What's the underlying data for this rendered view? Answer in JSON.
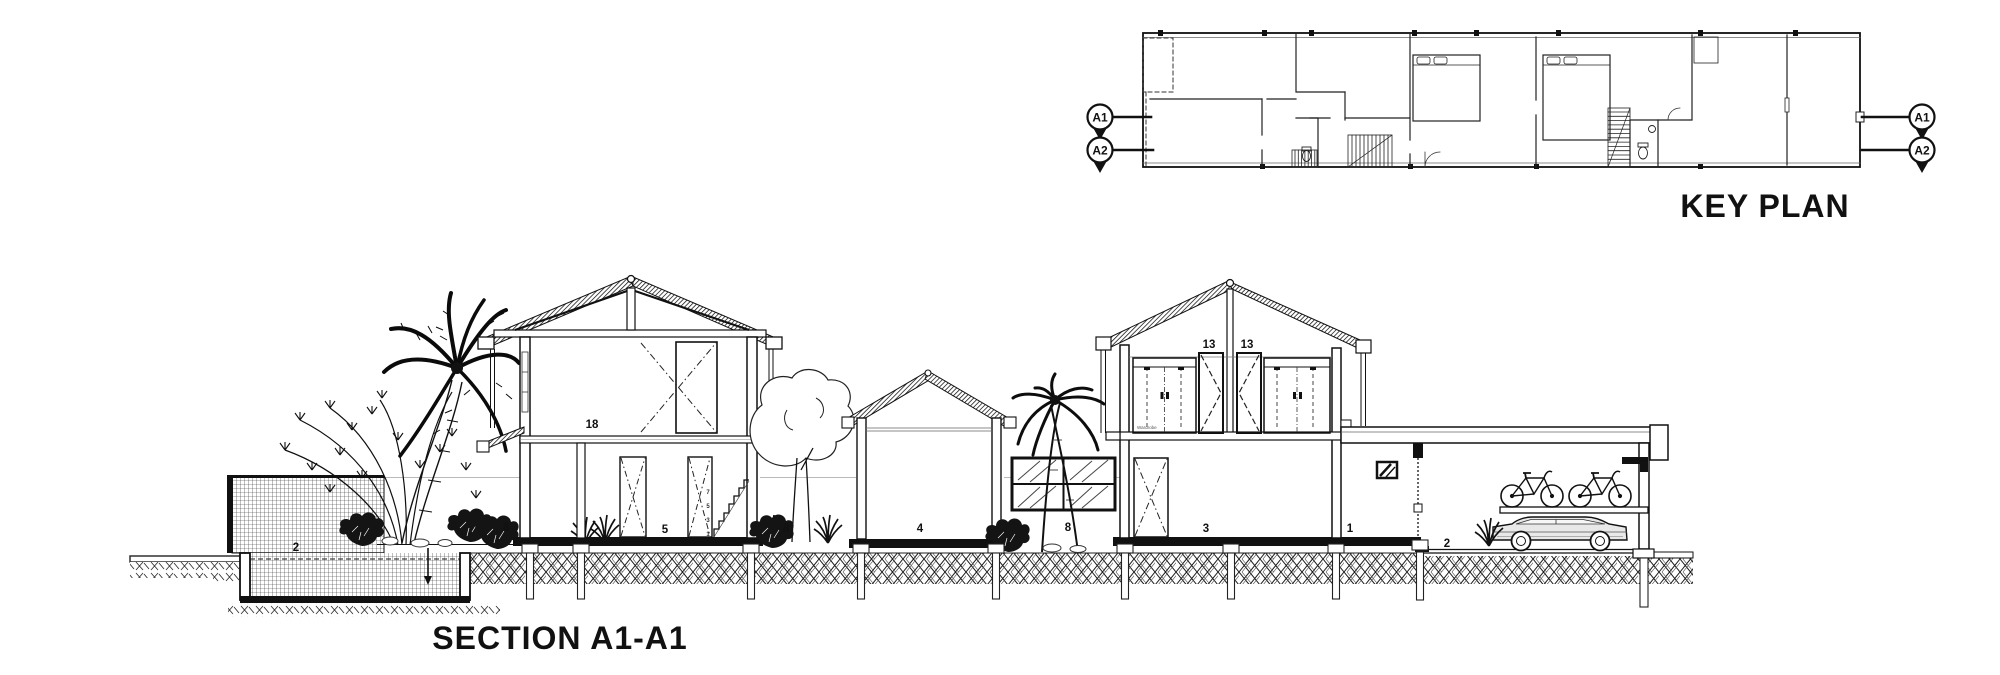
{
  "colors": {
    "accent_teal": "#17536a",
    "ink": "#111111"
  },
  "key_plan": {
    "title": "KEY PLAN",
    "section_markers": {
      "left": [
        {
          "label": "A1"
        },
        {
          "label": "A2"
        }
      ],
      "right": [
        {
          "label": "A1"
        },
        {
          "label": "A2"
        }
      ]
    }
  },
  "section": {
    "title": "SECTION A1-A1",
    "labels": {
      "water_tank": "2",
      "planting_left": "8",
      "upper_room": "18",
      "ground_room": "5",
      "stair_risers": [
        "7",
        "5",
        "3",
        "1"
      ],
      "planting_court": "8",
      "pavilion": "4",
      "palm_court": "8",
      "wardrobe_left": "13",
      "wardrobe_right": "13",
      "living_room": "3",
      "store_room": "1",
      "carport": "2",
      "wardrobe_note": "Wardrobe"
    }
  }
}
